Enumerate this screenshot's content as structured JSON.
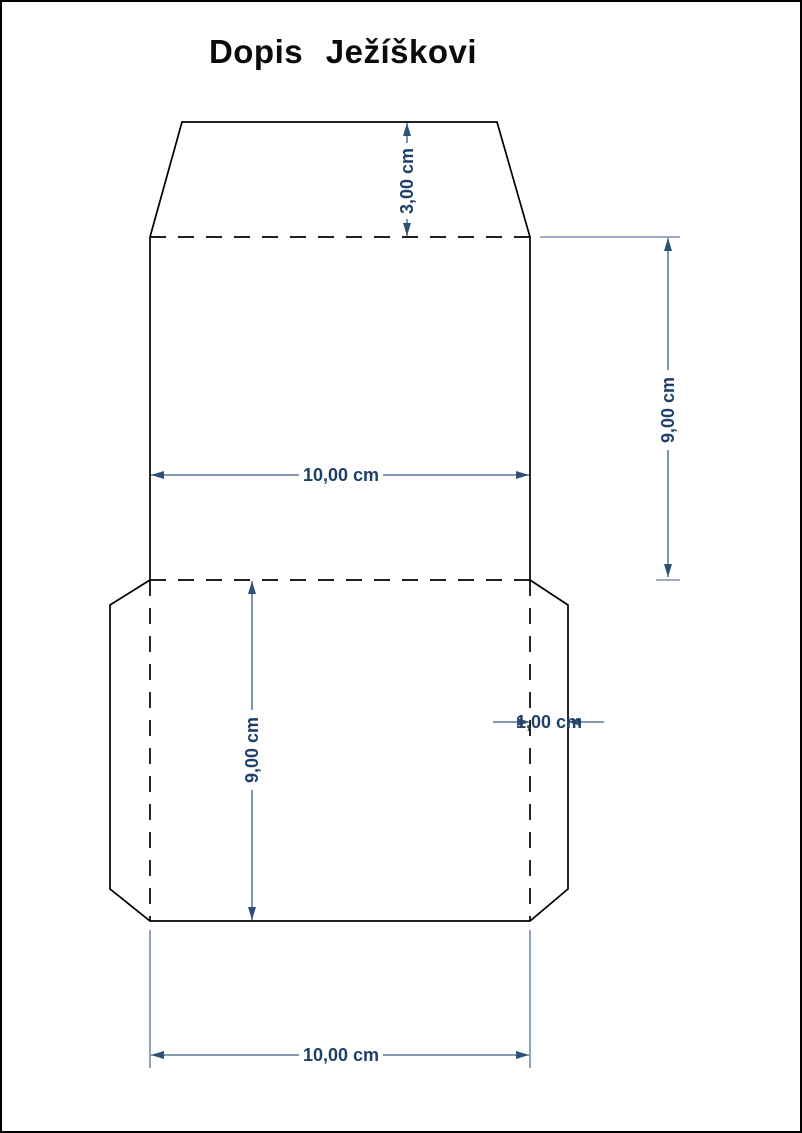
{
  "title": "Dopis Ježíškovi",
  "colors": {
    "page_background": "#FFFFFF",
    "page_border": "#000000",
    "cut_line": "#000000",
    "fold_line": "#000000",
    "dimension_line": "#3A5B87",
    "dimension_arrow": "#2E5077",
    "dimension_text": "#1F4068"
  },
  "drawing": {
    "type": "envelope-template",
    "dimensions": {
      "flap_height": {
        "label": "3,00 cm"
      },
      "body_width": {
        "label": "10,00 cm"
      },
      "body_height": {
        "label": "9,00 cm"
      },
      "back_height": {
        "label": "9,00 cm"
      },
      "side_flap_width": {
        "label": "1,00 cm"
      },
      "bottom_width": {
        "label": "10,00 cm"
      }
    }
  }
}
